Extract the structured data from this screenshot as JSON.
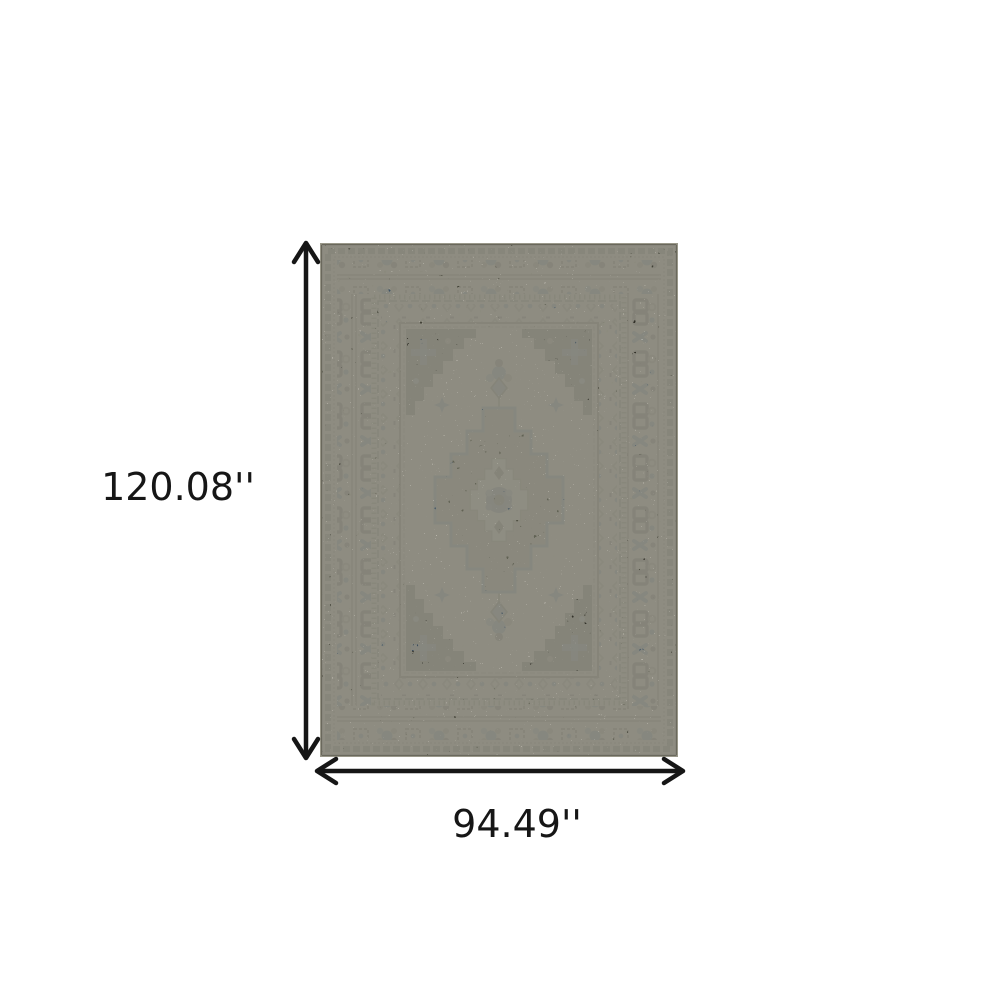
{
  "annotations": {
    "height": {
      "label": "120.08''",
      "orientation": "vertical"
    },
    "width": {
      "label": "94.49''",
      "orientation": "horizontal"
    }
  },
  "rug": {
    "description": "Ivory, grey and blue distressed oriental medallion area rug with ornate borders and dark corner spandrels"
  },
  "colors": {
    "canvas_background": "#ffffff",
    "dimension_line": "#161616",
    "rug_ivory": "#e8e5d9",
    "rug_charcoal": "#31302a",
    "rug_sage_grey": "#8e9180",
    "rug_blue": "#4d74a2"
  }
}
